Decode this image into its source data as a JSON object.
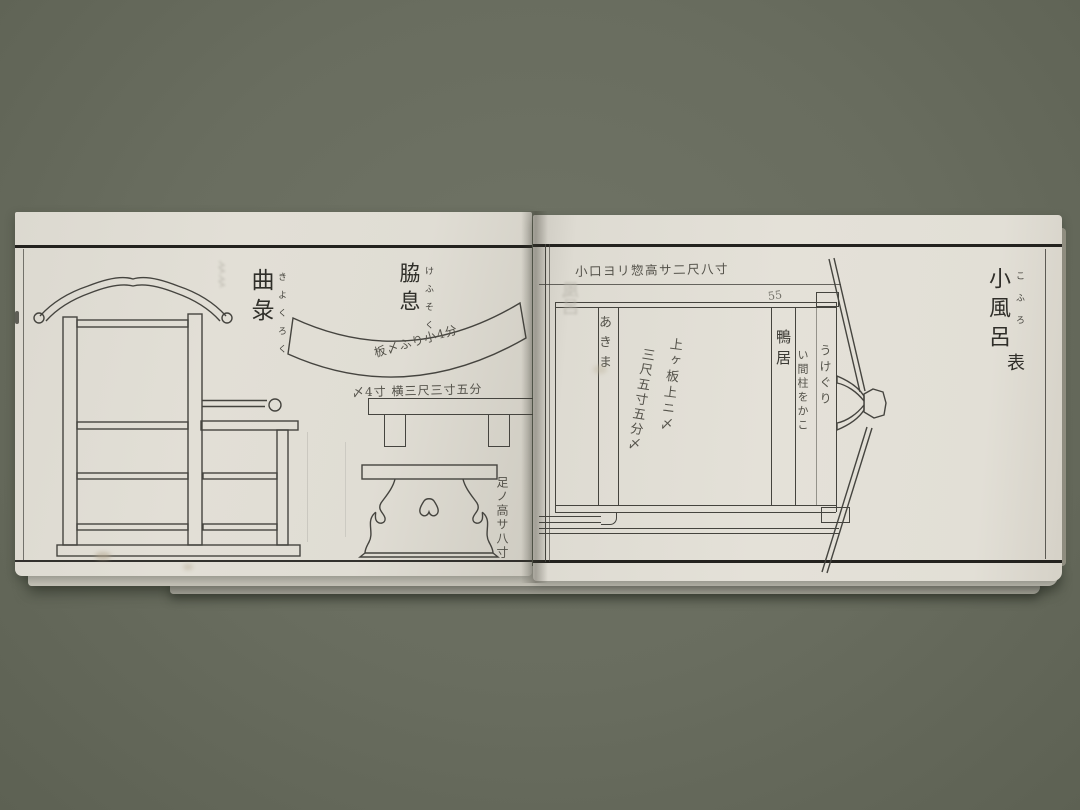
{
  "scene": {
    "description": "Photograph of an open Edo-period woodblock-printed Japanese pattern book showing furniture and bath diagrams",
    "background_color": "#696d5f",
    "paper_color": "#e2dfd6",
    "frame_ink": "#23221e",
    "drawing_ink": "#45443f",
    "handwriting_ink": "#54524a"
  },
  "left_page": {
    "chair_label": {
      "kanji": "曲彔",
      "furigana": "きよくろく"
    },
    "armrest_label": {
      "kanji": "脇息",
      "furigana": "けふそく"
    },
    "armrest_curve_note": "板〆ふり小4分",
    "bench_note": "〆4寸 横三尺三寸五分",
    "stand_note": "足ノ高サ八寸"
  },
  "right_page": {
    "title": {
      "kanji": "小風呂",
      "furigana": "こふろ",
      "side_label": "表"
    },
    "top_note": "小口ヨリ惣高サ二尺八寸",
    "corner_mark": "55",
    "left_band_label": "あきま",
    "center_note_right": "上ヶ板上ニ〆",
    "center_note_left": "三尺五寸五分〆",
    "band_kamoi": "鴨居",
    "band_hashira_note": "い間柱をかこ",
    "band_ukeguri": "うけぐり",
    "ghost_bleedthrough": "風呂"
  }
}
